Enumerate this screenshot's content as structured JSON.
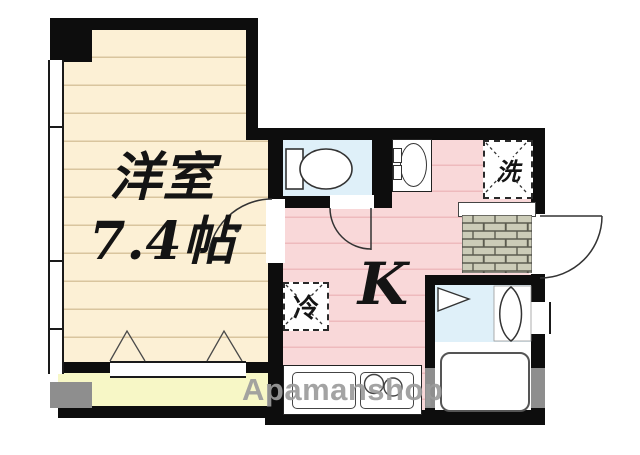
{
  "plan": {
    "rooms": {
      "western": {
        "name": "洋室",
        "size": "7.4帖"
      },
      "kitchen": {
        "label": "K"
      }
    },
    "fixtures": {
      "refrigerator": {
        "label": "冷"
      },
      "washer": {
        "label": "洗"
      }
    },
    "watermark": {
      "text": "Apamanshop"
    },
    "colors": {
      "western_room_floor": "#fcf0d5",
      "western_room_stripe": "#d9c59e",
      "kitchen_floor": "#f9d8d9",
      "kitchen_stripe": "#eebabd",
      "wet_area_floor": "#dff0f9",
      "balcony_floor": "#f7f7c6",
      "entry_tile": "#ccccb8",
      "wall": "#0d0d0d",
      "wall_gray": "#8e8e8e",
      "watermark_gray": "#9c9c9c"
    }
  }
}
